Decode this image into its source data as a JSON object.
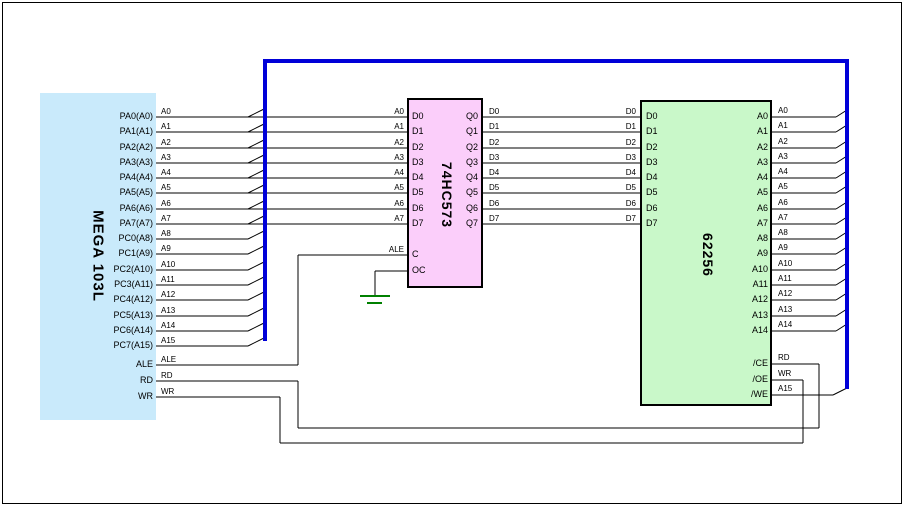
{
  "colors": {
    "bus": "#0000d8",
    "wire": "#000000",
    "ground": "#008000",
    "mcu_fill": "#c9eafb",
    "latch_fill": "#fbcefa",
    "ram_fill": "#c9f8c9"
  },
  "chips": {
    "mcu": {
      "label": "MEGA 103L",
      "pins_right": [
        "PA0(A0)",
        "PA1(A1)",
        "PA2(A2)",
        "PA3(A3)",
        "PA4(A4)",
        "PA5(A5)",
        "PA6(A6)",
        "PA7(A7)",
        "PC0(A8)",
        "PC1(A9)",
        "PC2(A10)",
        "PC3(A11)",
        "PC4(A12)",
        "PC5(A13)",
        "PC6(A14)",
        "PC7(A15)",
        "ALE",
        "RD",
        "WR"
      ]
    },
    "latch": {
      "label": "74HC573",
      "pins_left": [
        "D0",
        "D1",
        "D2",
        "D3",
        "D4",
        "D5",
        "D6",
        "D7",
        "C",
        "OC"
      ],
      "pins_right": [
        "Q0",
        "Q1",
        "Q2",
        "Q3",
        "Q4",
        "Q5",
        "Q6",
        "Q7"
      ]
    },
    "ram": {
      "label": "62256",
      "pins_left": [
        "D0",
        "D1",
        "D2",
        "D3",
        "D4",
        "D5",
        "D6",
        "D7"
      ],
      "pins_right": [
        "A0",
        "A1",
        "A2",
        "A3",
        "A4",
        "A5",
        "A6",
        "A7",
        "A8",
        "A9",
        "A10",
        "A11",
        "A12",
        "A13",
        "A14",
        "/CE",
        "/OE",
        "/WE"
      ]
    }
  },
  "wire_labels": {
    "mcu_out": [
      "A0",
      "A1",
      "A2",
      "A3",
      "A4",
      "A5",
      "A6",
      "A7",
      "A8",
      "A9",
      "A10",
      "A11",
      "A12",
      "A13",
      "A14",
      "A15",
      "ALE",
      "RD",
      "WR"
    ],
    "latch_in": [
      "A0",
      "A1",
      "A2",
      "A3",
      "A4",
      "A5",
      "A6",
      "A7",
      "ALE"
    ],
    "latch_out": [
      "D0",
      "D1",
      "D2",
      "D3",
      "D4",
      "D5",
      "D6",
      "D7"
    ],
    "ram_in": [
      "D0",
      "D1",
      "D2",
      "D3",
      "D4",
      "D5",
      "D6",
      "D7"
    ],
    "ram_out": [
      "A0",
      "A1",
      "A2",
      "A3",
      "A4",
      "A5",
      "A6",
      "A7",
      "A8",
      "A9",
      "A10",
      "A11",
      "A12",
      "A13",
      "A14",
      "RD",
      "WR",
      "A15"
    ]
  }
}
